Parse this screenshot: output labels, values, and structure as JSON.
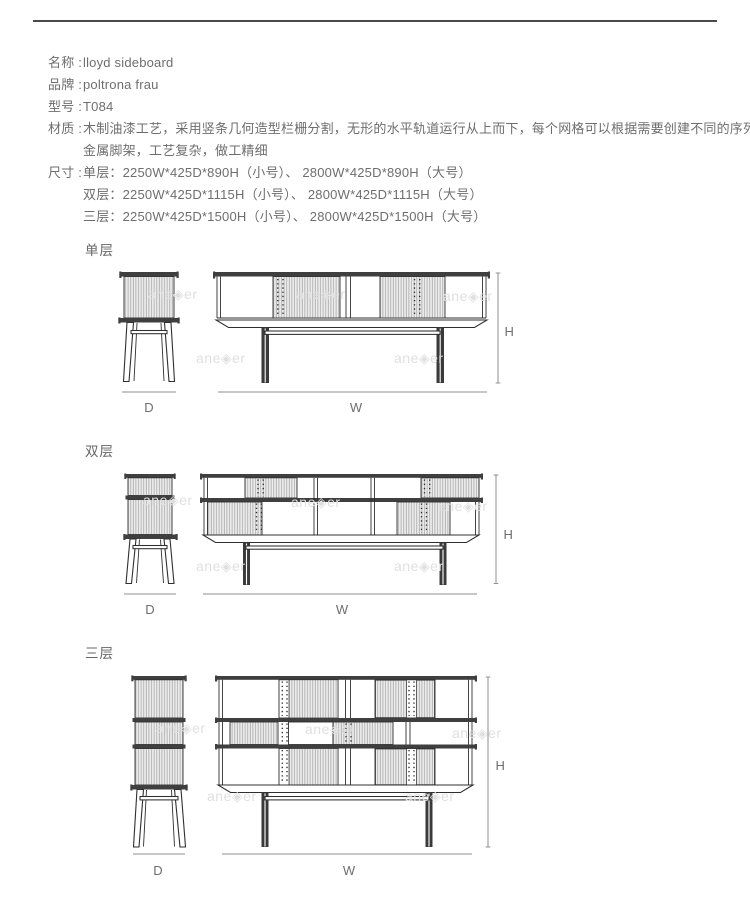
{
  "theme": {
    "text-color": "#6e6e6e",
    "rule-color": "#4a4a4a",
    "ink": "#2f2f2f",
    "bar": "#3f3f3f",
    "slat-bg": "#ededed",
    "slat-line": "#a6a6a6",
    "dim-line": "#8f8f8f",
    "watermark-color": "#e0e0e0",
    "page-bg": "#ffffff"
  },
  "watermark": {
    "text": "ane◈er"
  },
  "specs": {
    "rows": [
      {
        "label": "名称 :",
        "value": "lloyd sideboard"
      },
      {
        "label": "品牌 :",
        "value": "poltrona frau"
      },
      {
        "label": "型号 :",
        "value": "T084"
      },
      {
        "label": "材质 :",
        "value": "木制油漆工艺，采用竖条几何造型栏栅分割，无形的水平轨道运行从上而下，每个网格可以根据需要创建不同的序列，"
      },
      {
        "label": "",
        "value": "金属脚架，工艺复杂，做工精细"
      },
      {
        "label": "尺寸 :",
        "value": "单层：2250W*425D*890H（小号）、 2800W*425D*890H（大号）"
      },
      {
        "label": "",
        "value": "双层：2250W*425D*1115H（小号）、 2800W*425D*1115H（大号）"
      },
      {
        "label": "",
        "value": "三层：2250W*425D*1500H（小号）、 2800W*425D*1500H（大号）"
      }
    ]
  },
  "sections": [
    {
      "title": "单层",
      "depth_label": "D",
      "width_label": "W",
      "height_label": "H"
    },
    {
      "title": "双层",
      "depth_label": "D",
      "width_label": "W",
      "height_label": "H"
    },
    {
      "title": "三层",
      "depth_label": "D",
      "width_label": "W",
      "height_label": "H"
    }
  ]
}
